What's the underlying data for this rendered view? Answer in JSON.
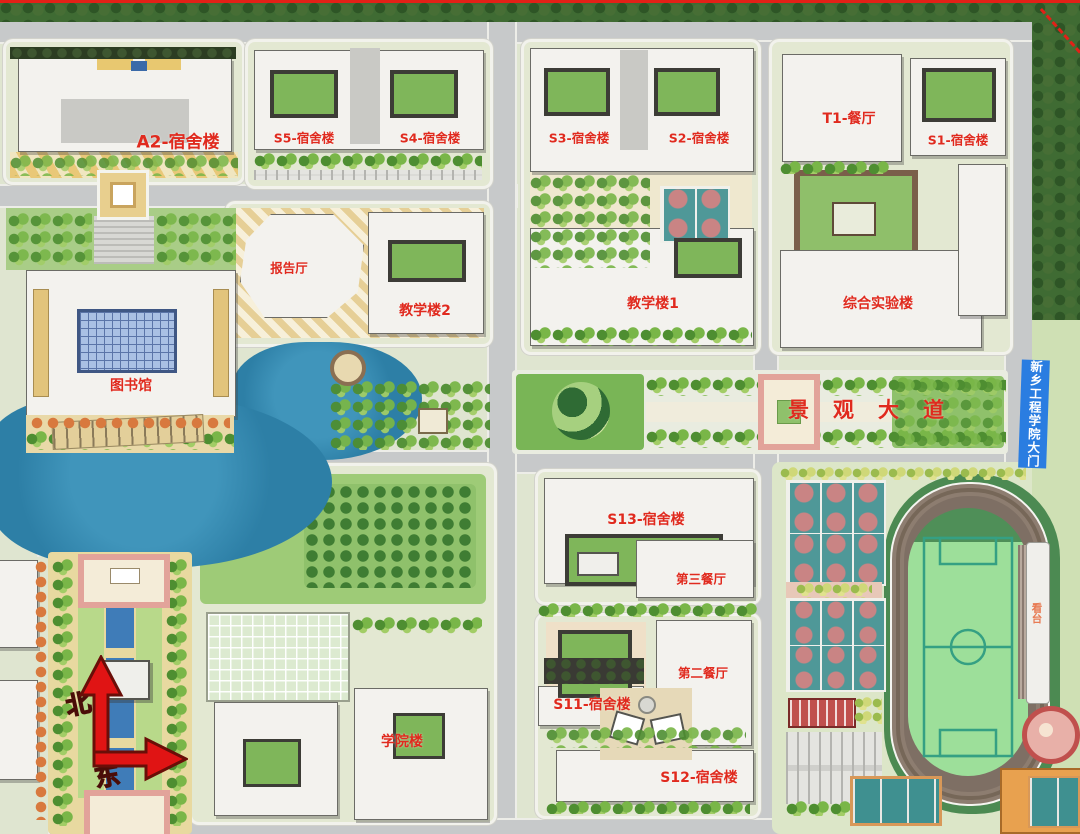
{
  "map": {
    "type": "campus-master-plan",
    "labels": {
      "a2": "A2-宿舍楼",
      "s5": "S5-宿舍楼",
      "s4": "S4-宿舍楼",
      "s3": "S3-宿舍楼",
      "s2": "S2-宿舍楼",
      "t1": "T1-餐厅",
      "s1": "S1-宿舍楼",
      "lecture_hall": "报告厅",
      "teaching2": "教学楼2",
      "teaching1": "教学楼1",
      "lab": "综合实验楼",
      "library": "图书馆",
      "avenue": "景观大道",
      "s13": "S13-宿舍楼",
      "canteen3": "第三餐厅",
      "canteen2": "第二餐厅",
      "s11": "S11-宿舍楼",
      "s12": "S12-宿舍楼",
      "college": "学院楼",
      "stand": "看台",
      "gate": "新乡工程学院大门",
      "north": "北",
      "east": "东"
    },
    "colors": {
      "label_red": "#e02a1e",
      "banner_blue": "#2a7de1",
      "stand_orange": "#e87b54",
      "lake_blue": "#2d7fa6",
      "track_brown": "#7e6f64",
      "field_green": "#9ddf9a",
      "court_teal": "#4f9898",
      "court_key_pink": "#c98484",
      "boundary_red": "#e32017"
    }
  }
}
